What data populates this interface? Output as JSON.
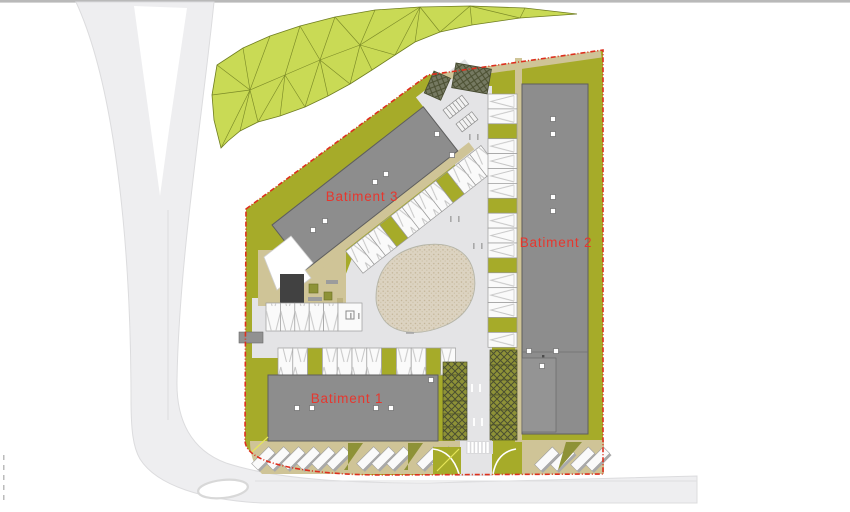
{
  "plan": {
    "title_labels": {
      "batiment1": "Batiment 1",
      "batiment2": "Batiment 2",
      "batiment3": "Batiment 3"
    },
    "buildings": [
      {
        "id": "batiment-3",
        "label": "Batiment 3"
      },
      {
        "id": "batiment-2",
        "label": "Batiment 2"
      },
      {
        "id": "batiment-1",
        "label": "Batiment 1"
      }
    ],
    "colors": {
      "site_green": "#a6ab29",
      "mesh_green": "#c9da55",
      "mesh_line": "#6f7d20",
      "building_gray": "#8d8d8d",
      "road_gray": "#e4e4e6",
      "outer_road_gray": "#eeeef0",
      "walkway_tan": "#cfc497",
      "plaza_beige": "#dcd3c1",
      "boundary_red": "#dd2f1e",
      "label_red": "#e6372e",
      "parking_stall_white": "#fafafa",
      "planted_stall_olive": "#8e9237",
      "carport_dark": "#757961"
    }
  }
}
